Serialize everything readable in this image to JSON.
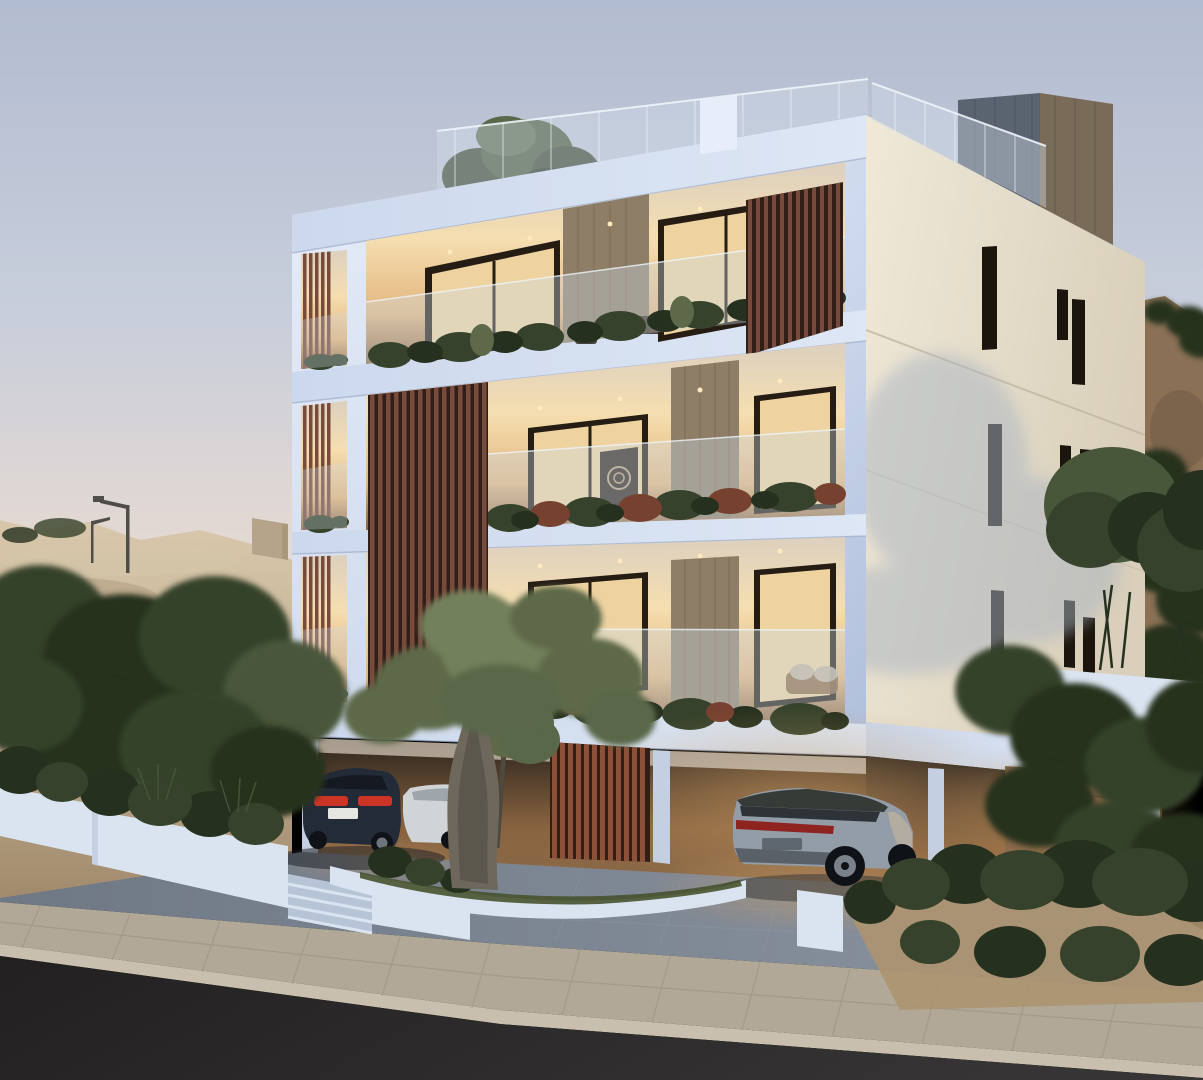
{
  "scene": {
    "title": "Modern apartment building exterior render at dusk",
    "setting": "hillside residential street with parked cars",
    "time_of_day": "dusk",
    "description": "Three-storey white apartment block with wooden slat screens, glass balconies, rooftop glass railing, covered parking with a dark sedan and a grey SUV, olive tree and planters in front, dirt hillside behind"
  },
  "objects": {
    "building": "white contemporary apartment block",
    "rooftop": "glass railing, roof garden tree, grey clad stair box",
    "side_wall": "cream wall with narrow slit windows",
    "parking": "open ground-floor parking with warm lighting and wood partitions",
    "vehicle_left": "dark blue sedan, rear view, red tail lights",
    "vehicle_mid": "white sedan partially hidden",
    "vehicle_right": "silver-grey SUV, rear three-quarter view",
    "foreground": "olive tree, white planter walls, steps, shrubs",
    "street": "concrete paver sidewalk and dark asphalt road",
    "background": "beige dirt hill with street lamps and dark green trees"
  },
  "palette": {
    "sky_top": "#b2bcd0",
    "sky_mid": "#c8cedb",
    "sky_low": "#e2d8d3",
    "sky_horizon": "#f0e3d8",
    "hill_light": "#d8c7ab",
    "hill_base": "#c3b094",
    "hill_shade": "#a18a6c",
    "hill_wall": "#b5a489",
    "hill_right": "#8a7156",
    "hill_right_dark": "#6d5741",
    "tree_dark": "#26301e",
    "tree_mid": "#36422b",
    "tree_light": "#48573a",
    "tree_pale": "#5a684a",
    "olive_leaf": "#5d6949",
    "olive_light": "#73805c",
    "olive_trunk": "#6e685c",
    "olive_trunk_dark": "#4e4940",
    "facade_light": "#e8eef9",
    "facade_mid": "#ccd8ec",
    "facade_shade": "#afbedb",
    "slab_face": "#dde7f5",
    "slab_edge": "#97a6c4",
    "cream_light": "#f0e9d8",
    "cream_dark": "#d9cfba",
    "slit": "#1c150d",
    "groove_line": "#c2b7a1",
    "shadow_soft": "#aab5c2",
    "wood_slat": "#784a3b",
    "wood_slat_dark": "#311f17",
    "wood_slat_lit": "#8d5038",
    "wood_clad": "#8f7e67",
    "wood_clad_dark": "#6a5943",
    "interior_bright": "#f5deb0",
    "interior_warm": "#e2b67e",
    "interior_dim": "#8a6440",
    "ceiling_glow": "#dcd0bf",
    "frame_dark": "#251d14",
    "glass_warm": "#eed3a1",
    "art_dark": "#2e251c",
    "balustrade": "#cdd9e4",
    "glass_edge": "#eef4f9",
    "glassrail": "#cfdce6",
    "box_blue": "#5a6471",
    "box_brown": "#7a6b59",
    "box_streak": "#434a55",
    "recess_dark": "#2a231d",
    "garage_glow": "#c79a63",
    "garage_wall": "#8a6a49",
    "plank_line": "#5d3f2a",
    "column_white": "#c4d0e1",
    "sedan_body": "#242b38",
    "sedan_dark": "#141922",
    "taillight": "#cc3526",
    "plate": "#e6e7e2",
    "wheel_dark": "#0f1216",
    "rim": "#878f99",
    "white_car": "#d0d4d7",
    "white_car_shade": "#9fa6ab",
    "suv_body": "#939da8",
    "suv_roof": "#363b38",
    "suv_dark": "#2e3338",
    "suv_tail": "#8e231f",
    "suv_bumper": "#596068",
    "suv_warm": "#c0b29e",
    "planter_white": "#dae4f0",
    "planter_shade": "#b7c4d8",
    "grass": "#46522e",
    "plant_red": "#77412f",
    "driveway": "#6f7885",
    "driveway_light": "#8c95a2",
    "paver_line": "#9aa2ae",
    "sidewalk": "#b1a897",
    "curb": "#c8bfae",
    "sidewalk_line": "#91887a",
    "road": "#373435",
    "road_dark": "#222021",
    "sand": "#ad9470",
    "lamp": "#4f4d48",
    "glow_warm": "#ffe9bd"
  }
}
